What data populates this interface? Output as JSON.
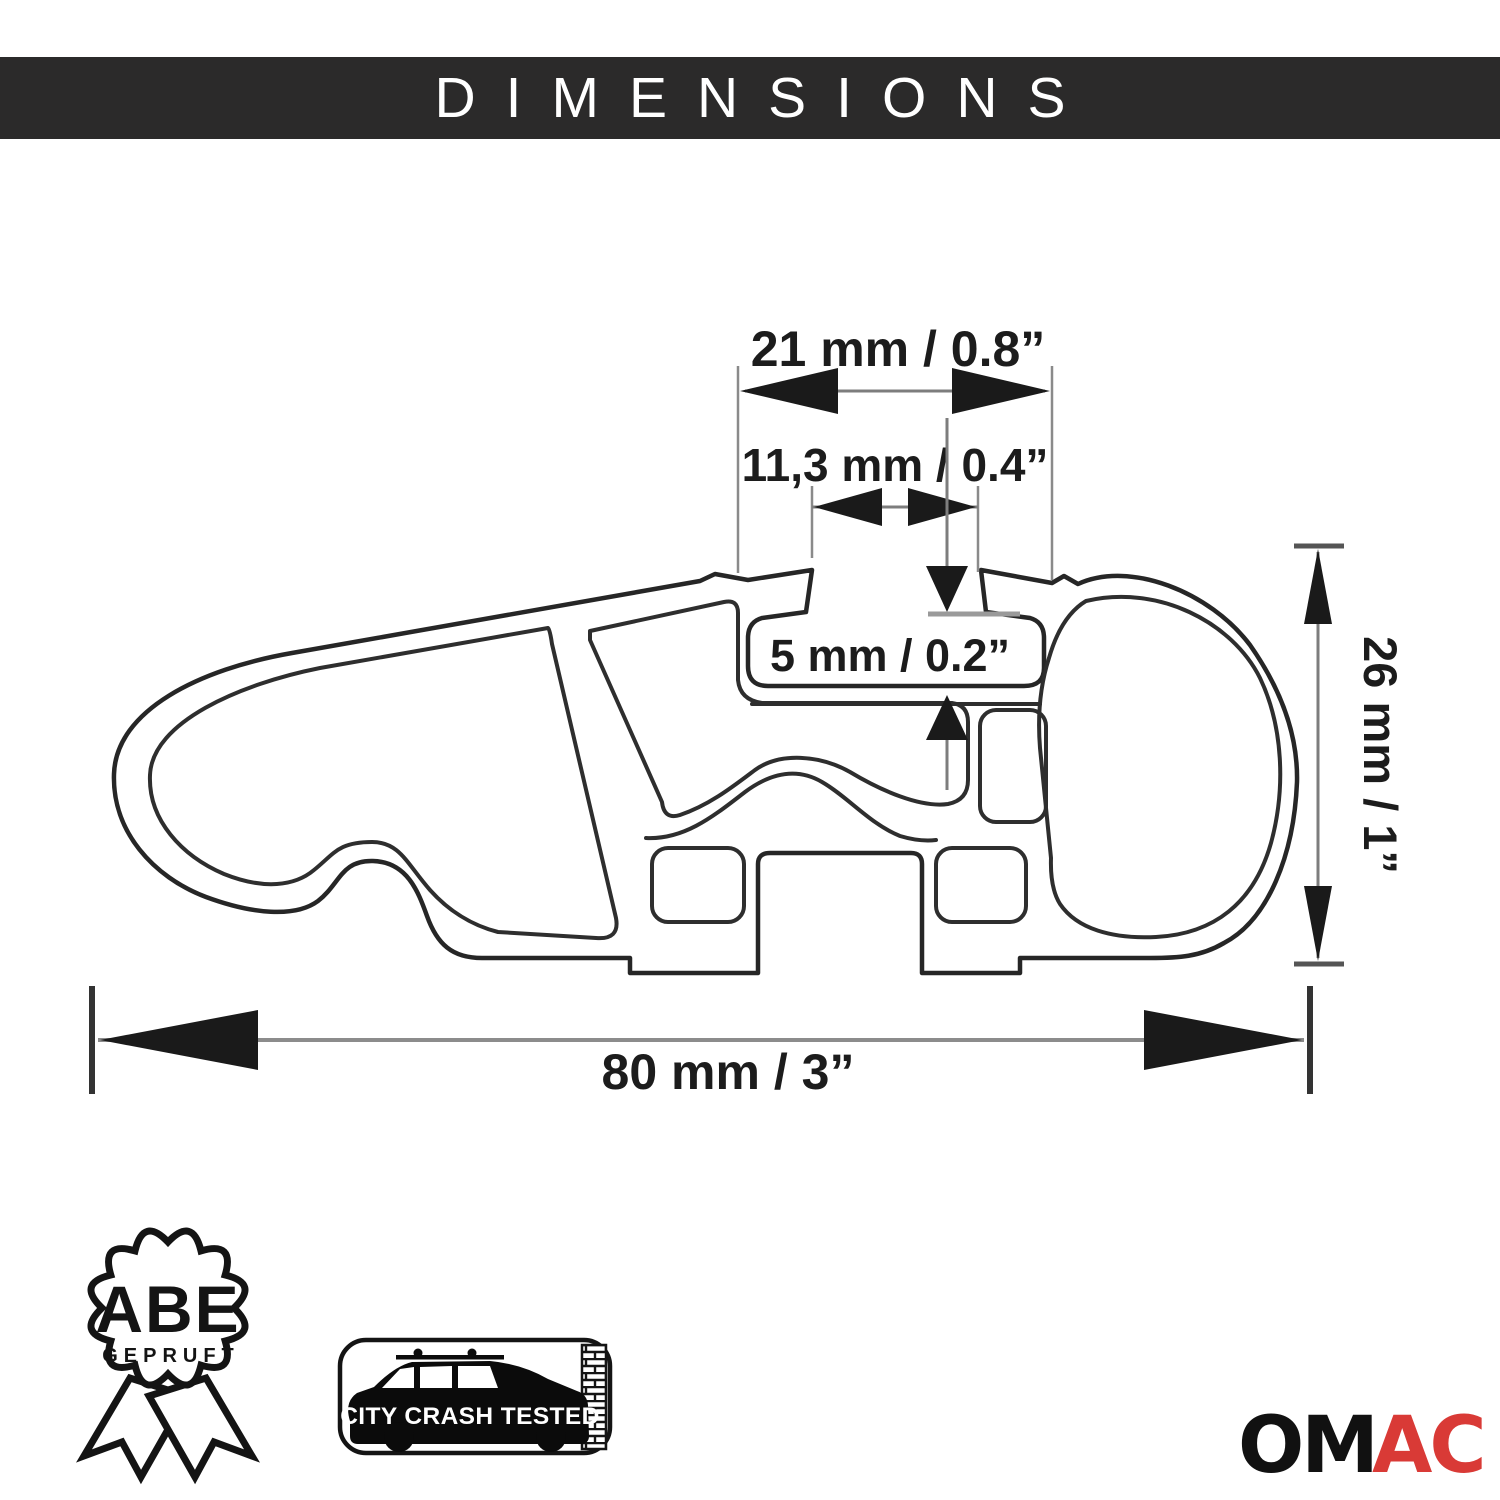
{
  "header": {
    "title": "DIMENSIONS",
    "bg_color": "#2b2a2a",
    "text_color": "#ffffff"
  },
  "dimensions": {
    "top_width": {
      "label": "21 mm / 0.8”"
    },
    "slot_width": {
      "label": "11,3 mm / 0.4”"
    },
    "lip_depth": {
      "label": "5 mm / 0.2”"
    },
    "height": {
      "label": "26 mm / 1”"
    },
    "total_width": {
      "label": "80 mm / 3”"
    }
  },
  "badges": {
    "abe": {
      "title": "ABE",
      "subtitle": "GEPRUFT"
    },
    "crash": {
      "label": "CITY CRASH TESTED"
    }
  },
  "brand": {
    "name_black": "OM",
    "name_red": "AC",
    "red_color": "#d93a36",
    "black_color": "#111111"
  },
  "drawing": {
    "line_color": "#262626"
  }
}
